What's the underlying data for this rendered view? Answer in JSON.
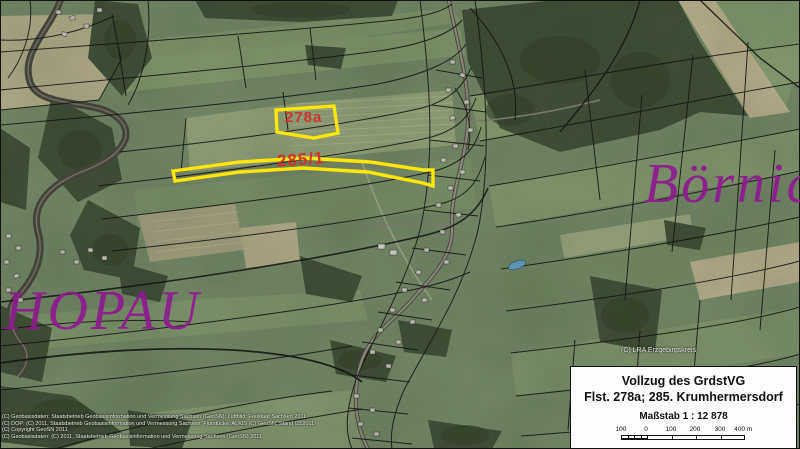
{
  "map": {
    "place_labels": {
      "left": "HOPAU",
      "right": "Börnic"
    },
    "parcels": [
      {
        "label": "278a"
      },
      {
        "label": "285/1"
      }
    ],
    "credit_overlay": "(C) LRA Erzgebirgskreis",
    "copyright_lines": [
      "(C) Geobasisdaten: Staatsbetrieb Geobasisinformation und Vermessung Sachsen (GeoSN); Luftbild: Freistaat Sachsen 2011",
      "(C) DOP: (C) 2011, Staatsbetrieb Geobasisinformation und Vermessung Sachsen; Flurstücke: ALKIS (C) GeoSN, Stand 03.2011",
      "(C) Copyright GeoSN 2011",
      "(C) Geobasisdaten: (C) 2011, Staatsbetrieb Geobasisinformation und Vermessung Sachsen (GeoSN) 2011"
    ],
    "colors": {
      "parcel_highlight": "#ffe606",
      "parcel_label": "#d22e24",
      "place_label": "#8e1b8e"
    }
  },
  "legend": {
    "title_line1": "Vollzug des GrdstVG",
    "title_line2": "Flst. 278a; 285. Krumhermersdorf",
    "scale_text": "Maßstab 1 : 12 878",
    "scale_bar_labels": [
      "100",
      "0",
      "100",
      "200",
      "300",
      "400 m"
    ]
  }
}
